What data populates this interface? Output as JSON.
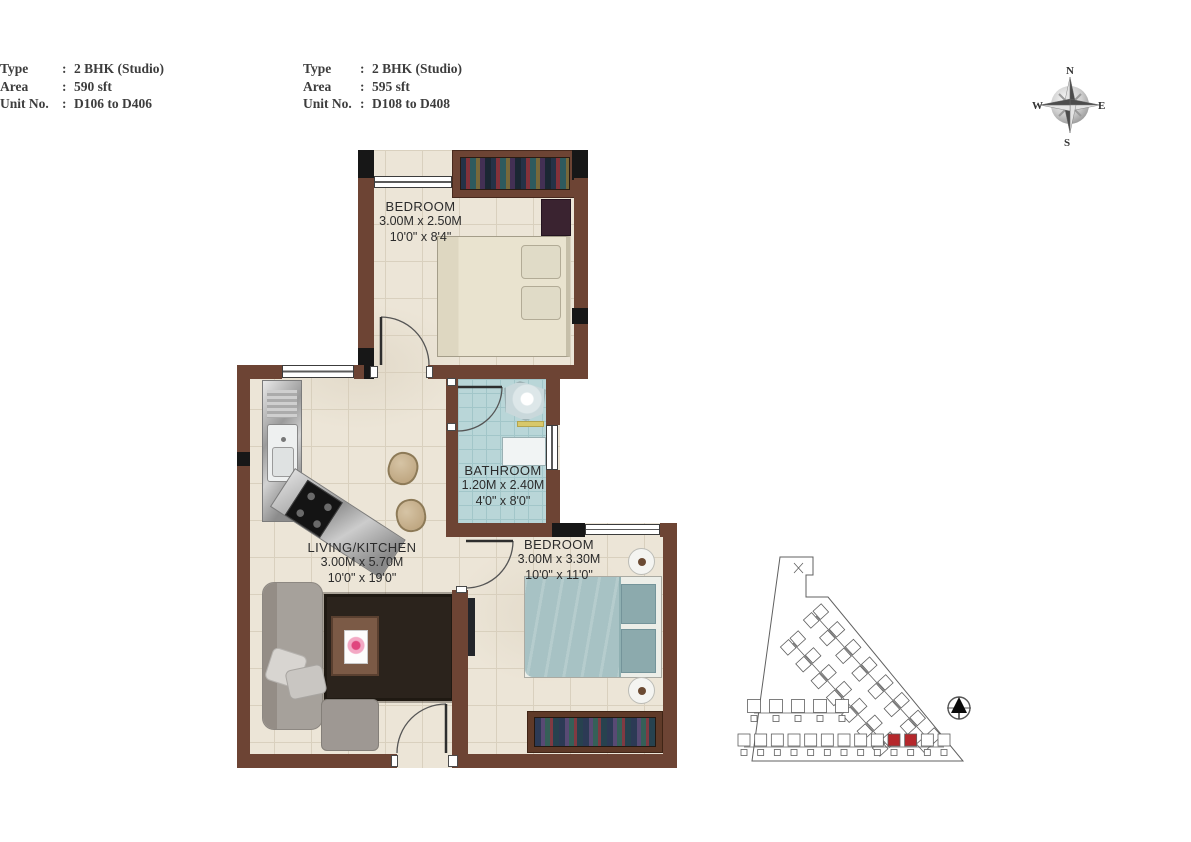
{
  "header": {
    "colon": ":",
    "blocks": [
      {
        "rows": [
          {
            "label": "Type",
            "value": "2 BHK (Studio)"
          },
          {
            "label": "Area",
            "value": "590 sft"
          },
          {
            "label": "Unit No.",
            "value": "D106 to D406"
          }
        ]
      },
      {
        "rows": [
          {
            "label": "Type",
            "value": "2 BHK (Studio)"
          },
          {
            "label": "Area",
            "value": "595 sft"
          },
          {
            "label": "Unit No.",
            "value": "D108 to D408"
          }
        ]
      }
    ]
  },
  "compass": {
    "north": "N",
    "east": "E",
    "south": "S",
    "west": "W"
  },
  "rooms": {
    "bedroom1": {
      "name": "BEDROOM",
      "dim_m": "3.00M x 2.50M",
      "dim_ft": "10'0\" x 8'4\""
    },
    "bathroom": {
      "name": "BATHROOM",
      "dim_m": "1.20M x 2.40M",
      "dim_ft": "4'0\" x 8'0\""
    },
    "living_kitchen": {
      "name": "LIVING/KITCHEN",
      "dim_m": "3.00M x 5.70M",
      "dim_ft": "10'0\" x 19'0\""
    },
    "bedroom2": {
      "name": "BEDROOM",
      "dim_m": "3.00M x 3.30M",
      "dim_ft": "10'0\" x 11'0\""
    }
  },
  "site_plan": {
    "highlighted_units": 2,
    "highlight_color": "#b5282c"
  },
  "colors": {
    "wall": "#6d4434",
    "black": "#171717",
    "floor": "#ece5d7",
    "floor_line": "#d9d0be",
    "bathroom_floor": "#b9d6d8",
    "bathroom_line": "#a2c6c9"
  }
}
